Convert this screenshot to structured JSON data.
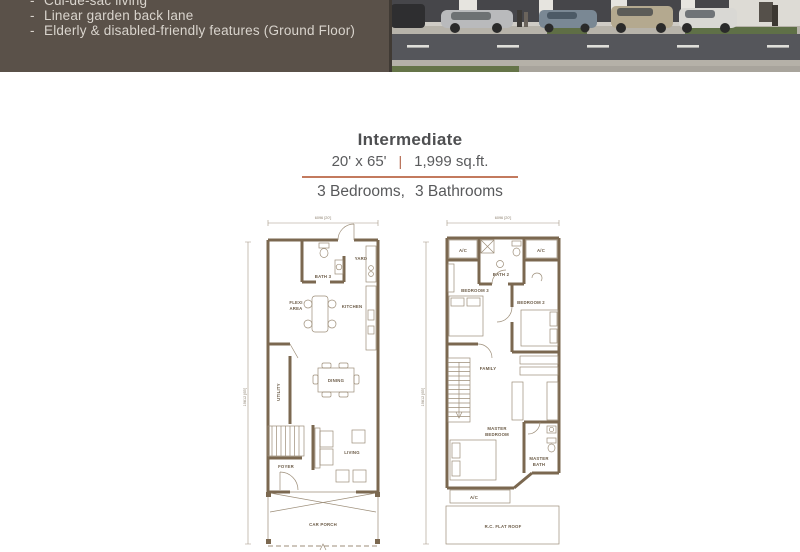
{
  "header": {
    "bullet": "-",
    "features": [
      "Cul-de-sac living",
      "Linear garden back lane",
      "Elderly & disabled-friendly features (Ground Floor)"
    ]
  },
  "unit": {
    "name": "Intermediate",
    "dimensions": "20' x 65'",
    "separator": "|",
    "area": "1,999 sq.ft.",
    "bedrooms": "3 Bedrooms,",
    "bathrooms": "3 Bathrooms"
  },
  "dims": {
    "width_label": "6096 [20']",
    "depth_label": "19812 [65']"
  },
  "ground_floor": {
    "labels": {
      "bath3": "BATH 3",
      "yard": "YARD",
      "kitchen": "KITCHEN",
      "flexi": [
        "FLEXI",
        "AREA"
      ],
      "utility": "UTILITY",
      "dining": "DINING",
      "living": "LIVING",
      "foyer": "FOYER",
      "car_porch": "CAR PORCH"
    }
  },
  "first_floor": {
    "labels": {
      "ac": "A/C",
      "bath2": "BATH 2",
      "bedroom3": "BEDROOM 3",
      "bedroom2": "BEDROOM 2",
      "family": "FAMILY",
      "master_bedroom": [
        "MASTER",
        "BEDROOM"
      ],
      "master_bath": [
        "MASTER",
        "BATH"
      ],
      "flat_roof": "R.C. FLAT ROOF"
    }
  },
  "colors": {
    "header_bg": "#5a5149",
    "header_text": "#d9d4cd",
    "accent_line": "#c37a5e",
    "plan_wall": "#7b6850",
    "title_text": "#4e4f51"
  }
}
